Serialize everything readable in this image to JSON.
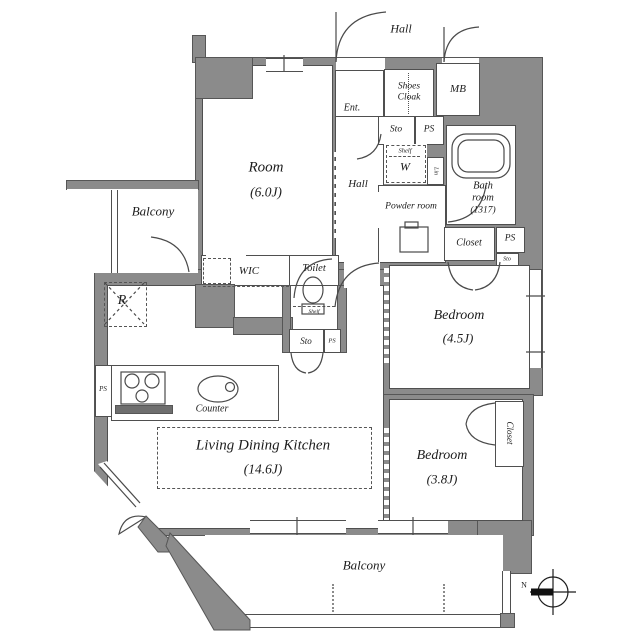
{
  "colors": {
    "wall": "#8b8b8b",
    "line": "#4a4a4a",
    "text": "#1c1c1c"
  },
  "compass": {
    "north": "N"
  },
  "labels": {
    "common_hall": "Hall",
    "entrance": "Ent.",
    "shoes_cloak": "Shoes Cloak",
    "meter_box": "MB",
    "entry_storage": "Sto",
    "entry_pipe_space": "PS",
    "laundry_shelf": "Shelf",
    "washer": "W",
    "linen": "Lin",
    "bathroom": "Bath room",
    "bathroom_size": "(1317)",
    "powder_room": "Powder room",
    "hall_closet": "Closet",
    "hall_ps": "PS",
    "hall_sto": "Sto",
    "room": "Room",
    "room_size": "(6.0J)",
    "inner_hall": "Hall",
    "west_balcony": "Balcony",
    "wic": "WIC",
    "toilet": "Toilet",
    "toilet_shelf": "Shelf",
    "toilet_sto": "Sto",
    "toilet_ps": "PS",
    "refrigerator": "R",
    "kitchen_ps": "PS",
    "counter": "Counter",
    "ldk": "Living Dining Kitchen",
    "ldk_size": "(14.6J)",
    "bedroom1": "Bedroom",
    "bedroom1_size": "(4.5J)",
    "bedroom2": "Bedroom",
    "bedroom2_size": "(3.8J)",
    "bedroom2_closet": "Closet",
    "south_balcony": "Balcony"
  }
}
